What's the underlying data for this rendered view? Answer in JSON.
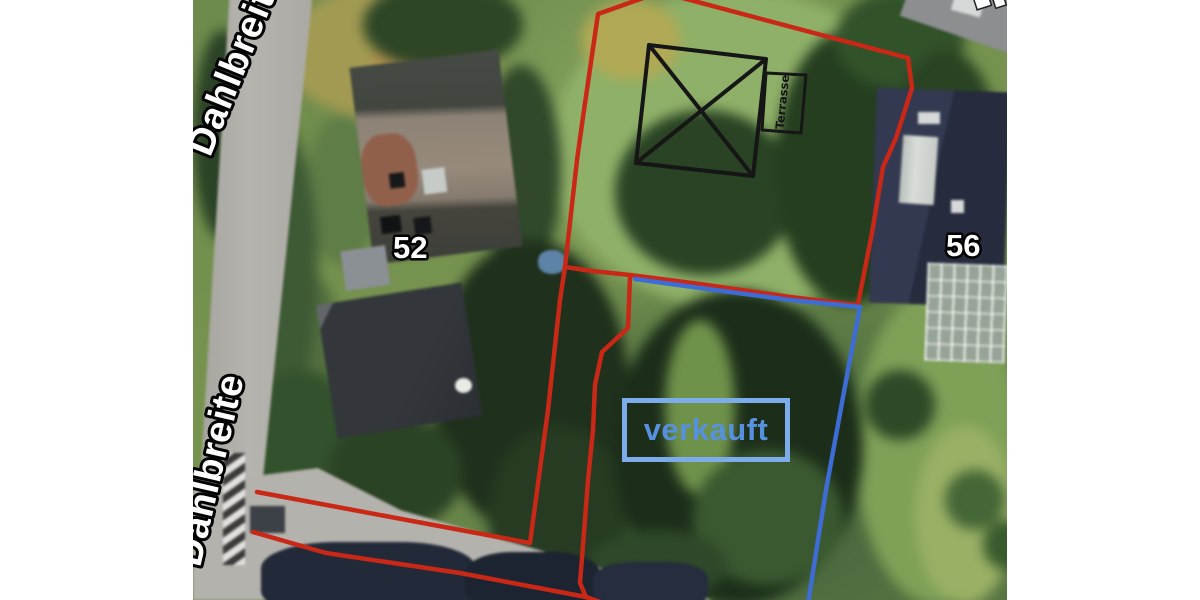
{
  "labels": {
    "street_top": "Dahlbreite",
    "street_bottom": "Dahlbreite",
    "house_52": "52",
    "house_56": "56",
    "sold": "verkauft",
    "terrace": "Terrasse"
  },
  "colors": {
    "red": "#c92817",
    "blue": "#3c6cd4",
    "sold-border": "#7cadea",
    "sold-text": "#5691df",
    "sketch": "#161616",
    "label-fill": "#ffffff",
    "label-stroke": "#000000"
  }
}
